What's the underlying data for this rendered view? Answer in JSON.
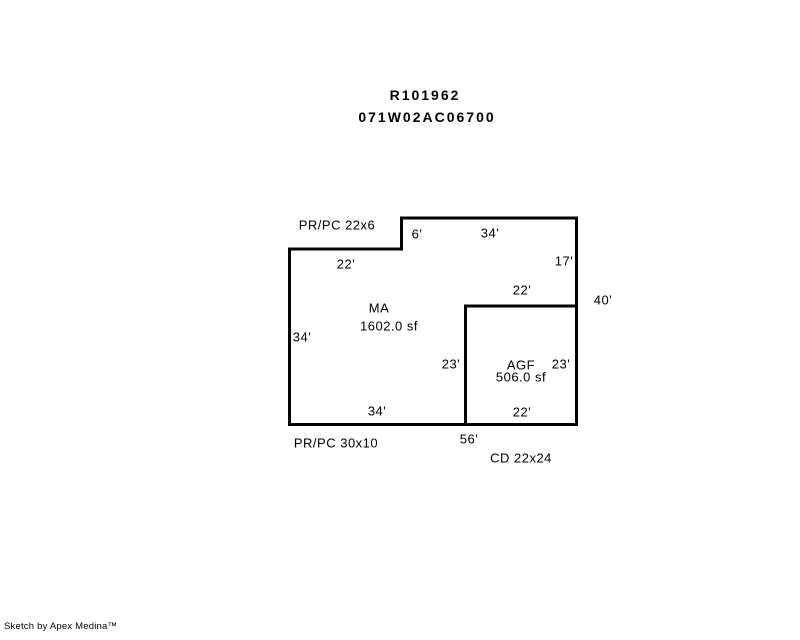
{
  "page": {
    "background": "#ffffff",
    "line_color": "#000000",
    "text_color": "#000000"
  },
  "header": {
    "record_id": "R101962",
    "parcel_id": "071W02AC06700"
  },
  "sketch": {
    "areas": {
      "ma": {
        "code": "MA",
        "size": "1602.0 sf"
      },
      "agf": {
        "code": "AGF",
        "size": "506.0 sf"
      }
    },
    "features": {
      "porch_top": "PR/PC 22x6",
      "porch_bottom": "PR/PC 30x10",
      "carport": "CD 22x24"
    },
    "dims": {
      "top_notch": "6'",
      "top": "34'",
      "upper_left": "22'",
      "right_upper": "17'",
      "agf_top": "22'",
      "right_total": "40'",
      "left": "34'",
      "agf_left": "23'",
      "agf_right": "23'",
      "ma_bottom": "34'",
      "agf_bottom": "22'",
      "bottom_total": "56'"
    }
  },
  "footer": {
    "credit": "Sketch by Apex Medina™"
  }
}
